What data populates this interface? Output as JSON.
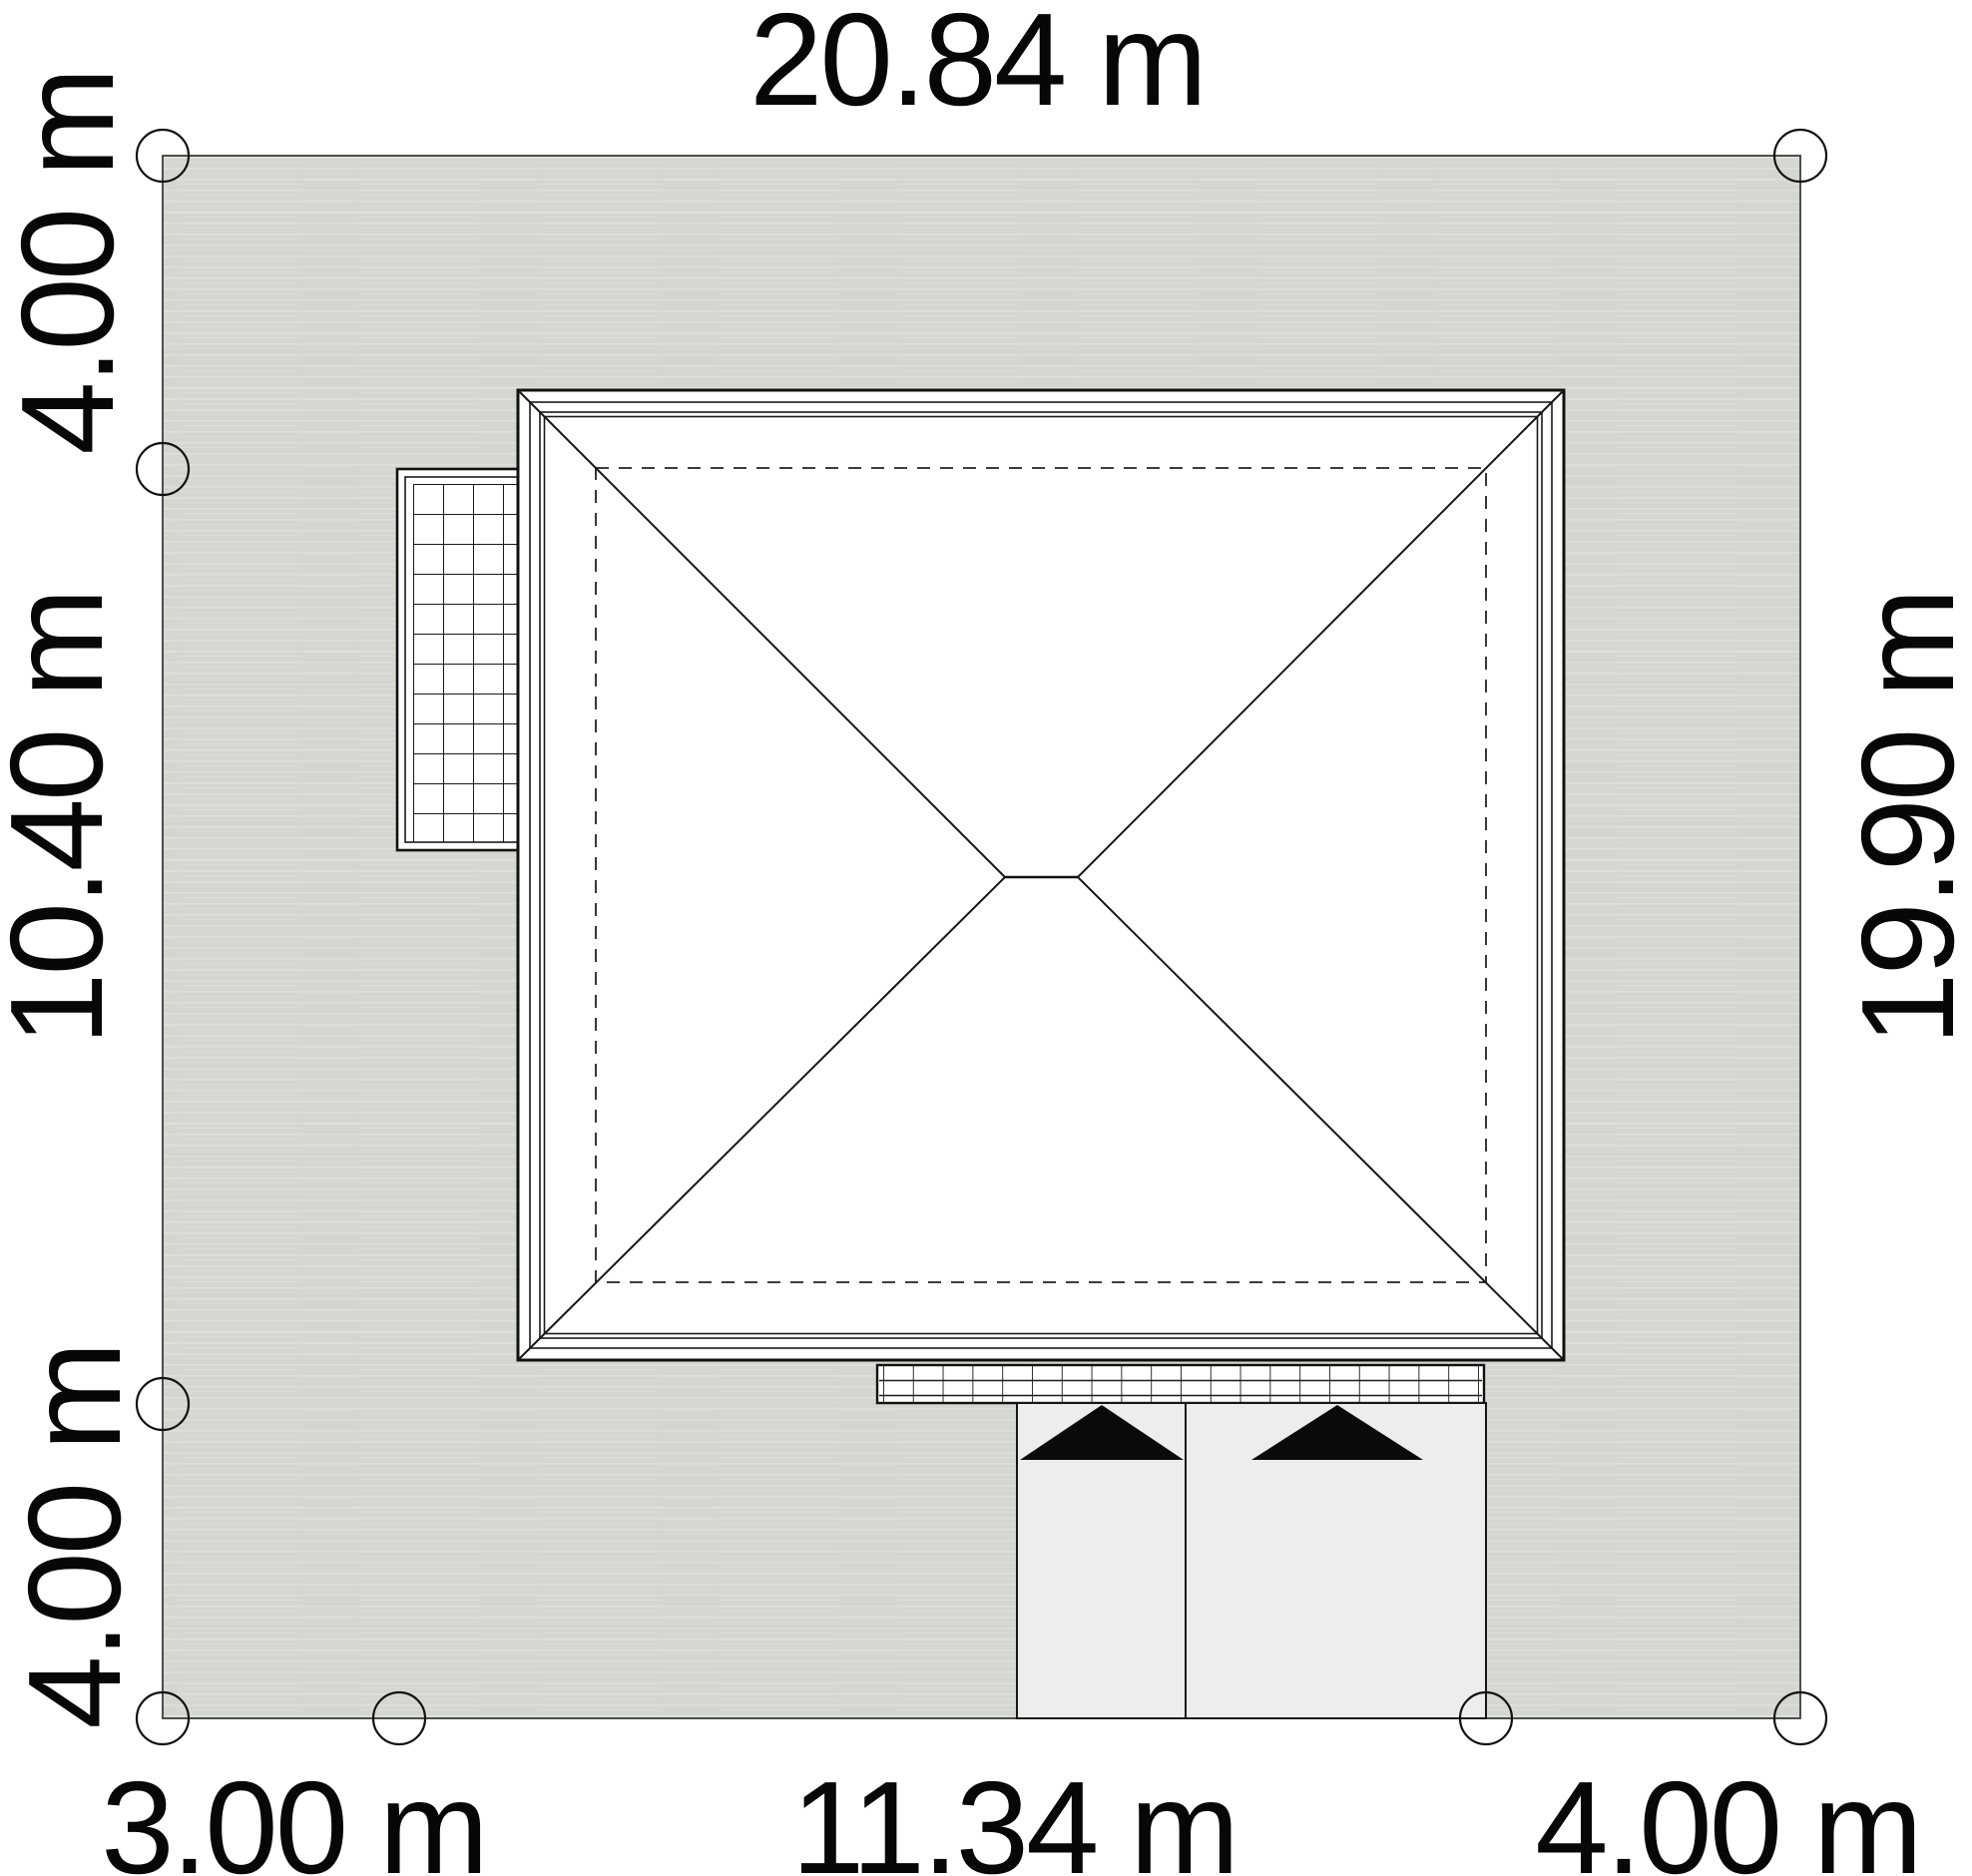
{
  "drawing": {
    "kind": "house-site-plan-roof-view",
    "dimensions": {
      "top_width": "20.84 m",
      "left_top": "4.00 m",
      "left_middle": "10.40 m",
      "left_bottom": "4.00 m",
      "right_depth": "19.90 m",
      "bottom_left": "3.00 m",
      "bottom_middle": "11.34 m",
      "bottom_right": "4.00 m"
    },
    "plot": {
      "width_m": 20.84,
      "depth_m": 19.9,
      "left_segments_m": [
        4.0,
        10.4,
        4.0
      ],
      "bottom_segments_m": [
        3.0,
        11.34,
        4.0
      ]
    },
    "colors": {
      "background": "#ffffff",
      "plot_fill": "#d4d7d1",
      "paving_fill": "#ededee",
      "structure_fill": "#ffffff",
      "line": "#1a1a1a",
      "arrow_fill": "#0a0a0a"
    }
  }
}
